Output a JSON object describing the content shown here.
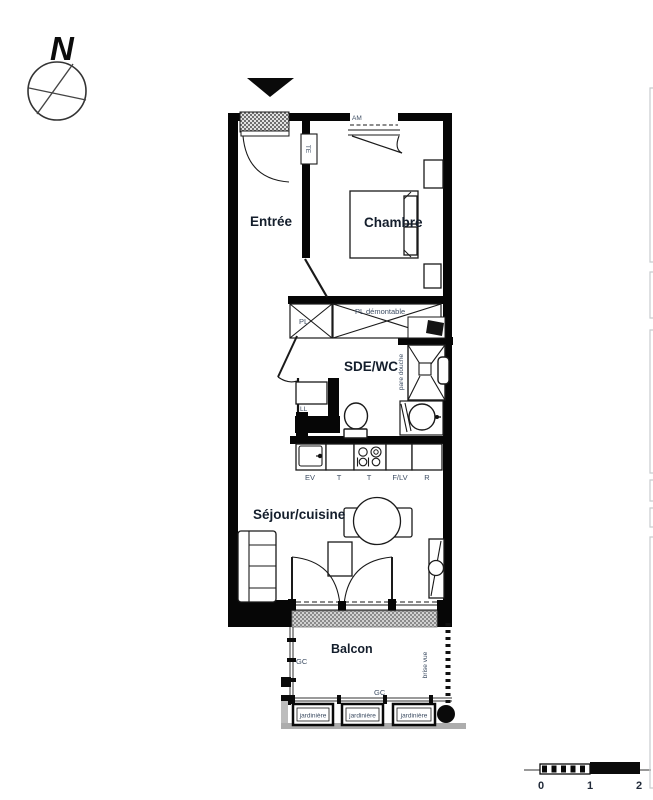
{
  "north": {
    "letter": "N"
  },
  "rooms": {
    "entree": "Entrée",
    "chambre": "Chambre",
    "sde_wc": "SDE/WC",
    "sejour_cuisine": "Séjour/cuisine",
    "balcon": "Balcon"
  },
  "fixtures": {
    "te": "TE",
    "am": "AM",
    "pl": "PL",
    "pl_demontable": "PL démontable",
    "pare_douche": "pare douche",
    "ll": "LL",
    "ev": "EV",
    "t": "T",
    "f_lv": "F/LV",
    "r": "R",
    "gc": "GC",
    "brise_vue": "brise vue",
    "jardiniere": "jardinière"
  },
  "scale_bar": {
    "tick_0": "0",
    "tick_1": "1",
    "tick_2": "2"
  },
  "colors": {
    "wall": "#060606",
    "room_label": "#141e2c",
    "fixture_label": "#3d4d63",
    "hatch_gray": "#8f8f8f",
    "balcony_gray": "#a8a8a8",
    "page_edge_gray": "#c8ccce"
  }
}
